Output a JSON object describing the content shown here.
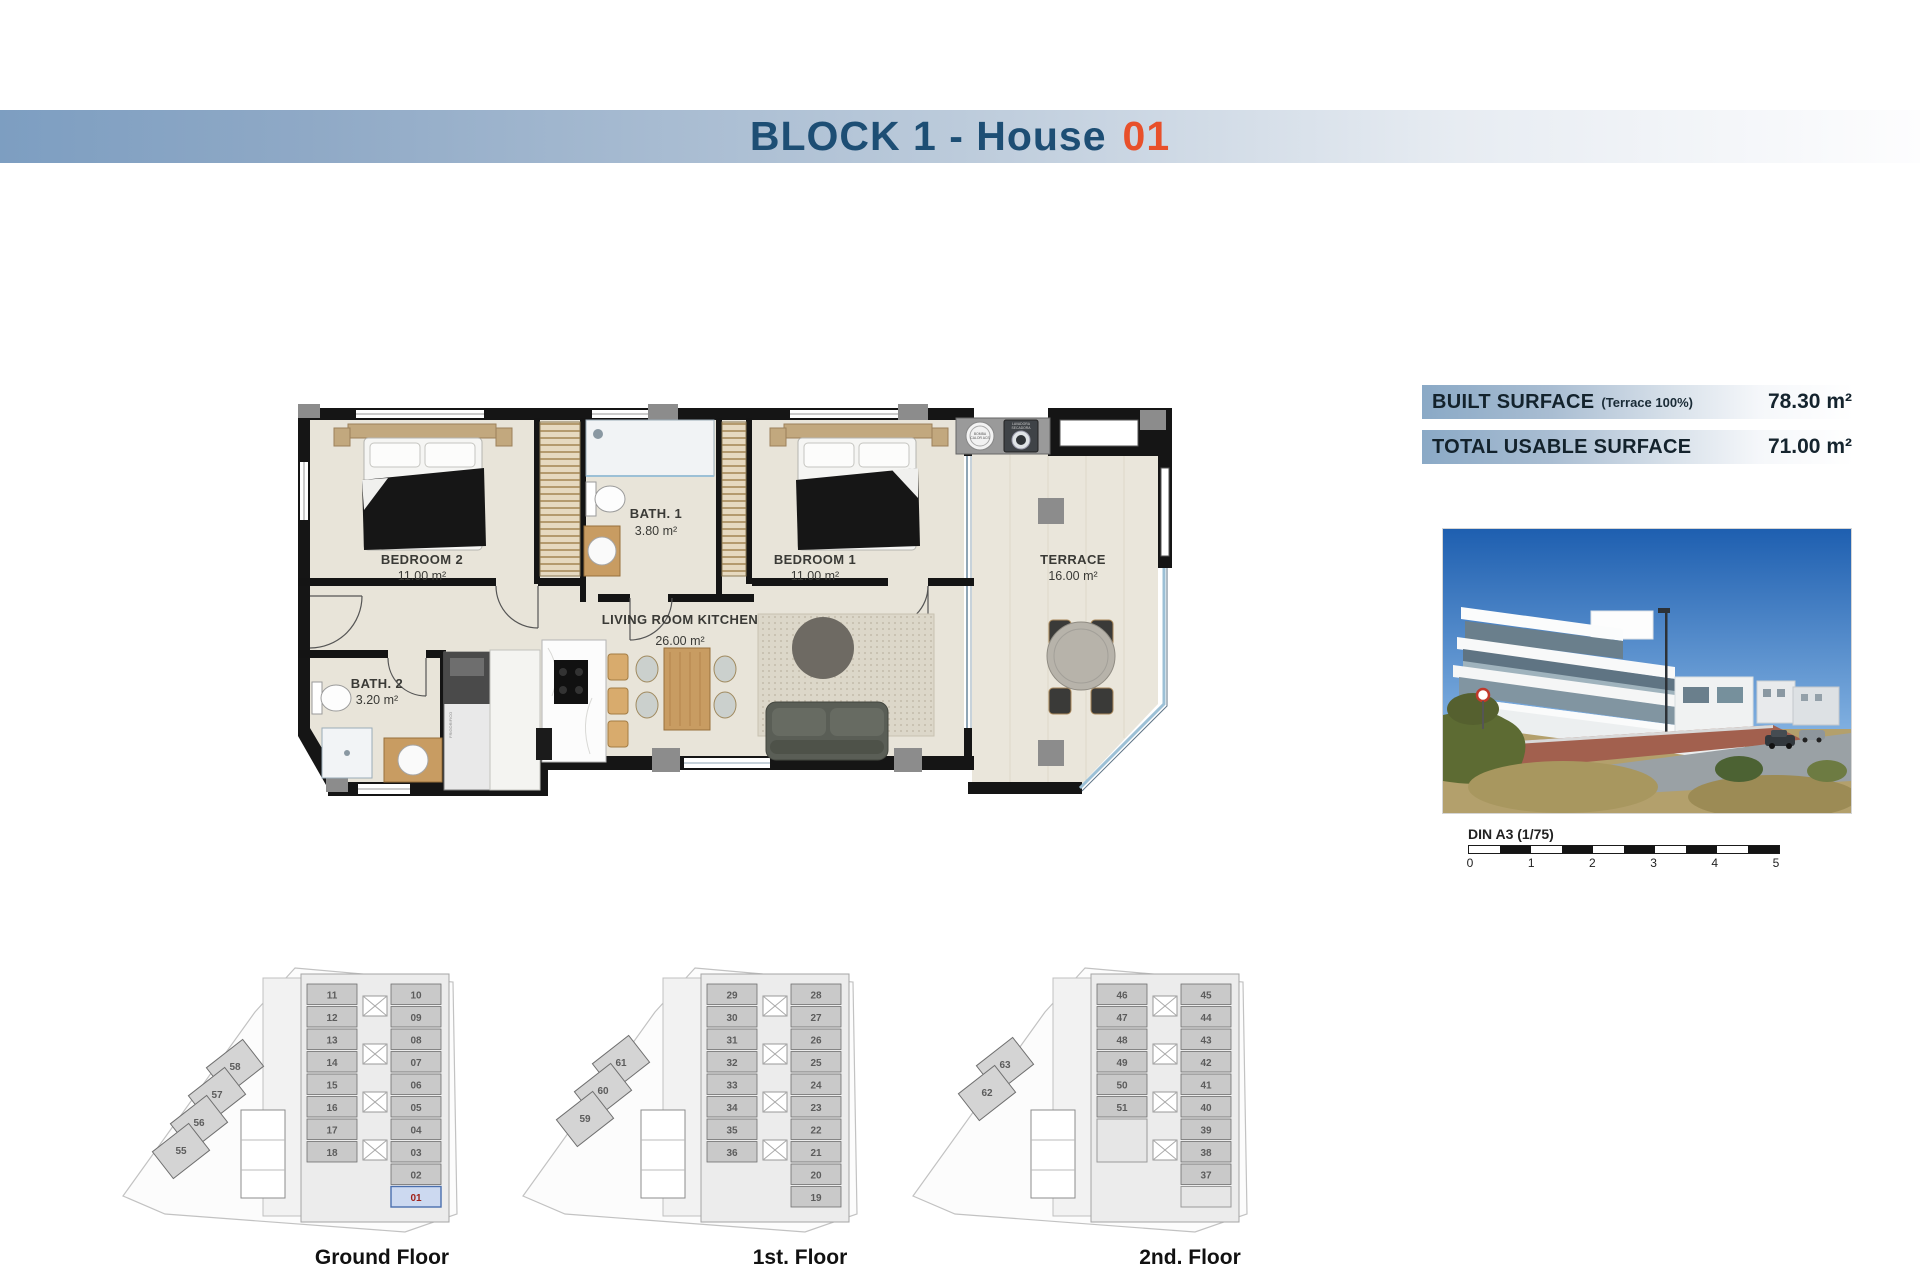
{
  "header": {
    "title_main": "BLOCK 1 - House",
    "title_number": "01"
  },
  "surface_table": {
    "rows": [
      {
        "label": "BUILT SURFACE",
        "note": "(Terrace 100%)",
        "value": "78.30 m²"
      },
      {
        "label": "TOTAL USABLE SURFACE",
        "note": "",
        "value": "71.00 m²"
      }
    ]
  },
  "floorplan": {
    "rooms": [
      {
        "id": "bedroom2",
        "name": "BEDROOM 2",
        "area": "11.00 m²"
      },
      {
        "id": "bath1",
        "name": "BATH. 1",
        "area": "3.80 m²"
      },
      {
        "id": "bedroom1",
        "name": "BEDROOM 1",
        "area": "11.00 m²"
      },
      {
        "id": "living",
        "name": "LIVING ROOM KITCHEN",
        "area": "26.00 m²"
      },
      {
        "id": "bath2",
        "name": "BATH. 2",
        "area": "3.20 m²"
      },
      {
        "id": "terrace",
        "name": "TERRACE",
        "area": "16.00 m²"
      }
    ],
    "utility": {
      "heat_pump_1": "BOMBA",
      "heat_pump_2": "CALOR ACS",
      "washer_1": "LAVADORA",
      "washer_2": "SECADORA",
      "fridge": "FRIGORIFICO"
    }
  },
  "scalebar": {
    "label": "DIN A3 (1/75)",
    "ticks": [
      "0",
      "1",
      "2",
      "3",
      "4",
      "5"
    ]
  },
  "floors": [
    {
      "label": "Ground Floor",
      "left_units": [
        "11",
        "12",
        "13",
        "14",
        "15",
        "16",
        "17",
        "18"
      ],
      "right_units": [
        "10",
        "09",
        "08",
        "07",
        "06",
        "05",
        "04",
        "03",
        "02",
        "01"
      ],
      "wing_units": [
        "58",
        "57",
        "56",
        "55"
      ],
      "highlight": "01"
    },
    {
      "label": "1st. Floor",
      "left_units": [
        "29",
        "30",
        "31",
        "32",
        "33",
        "34",
        "35",
        "36"
      ],
      "right_units": [
        "28",
        "27",
        "26",
        "25",
        "24",
        "23",
        "22",
        "21",
        "20",
        "19"
      ],
      "wing_units": [
        "61",
        "60",
        "59"
      ],
      "highlight": ""
    },
    {
      "label": "2nd. Floor",
      "left_units": [
        "46",
        "47",
        "48",
        "49",
        "50",
        "51"
      ],
      "right_units": [
        "45",
        "44",
        "43",
        "42",
        "41",
        "40",
        "39",
        "38",
        "37"
      ],
      "wing_units": [
        "63",
        "62"
      ],
      "highlight": ""
    }
  ],
  "colors": {
    "accent_blue": "#1d4e74",
    "accent_orange": "#e8502a",
    "highlight_fill": "#ccd9f0",
    "highlight_text": "#a02018"
  }
}
